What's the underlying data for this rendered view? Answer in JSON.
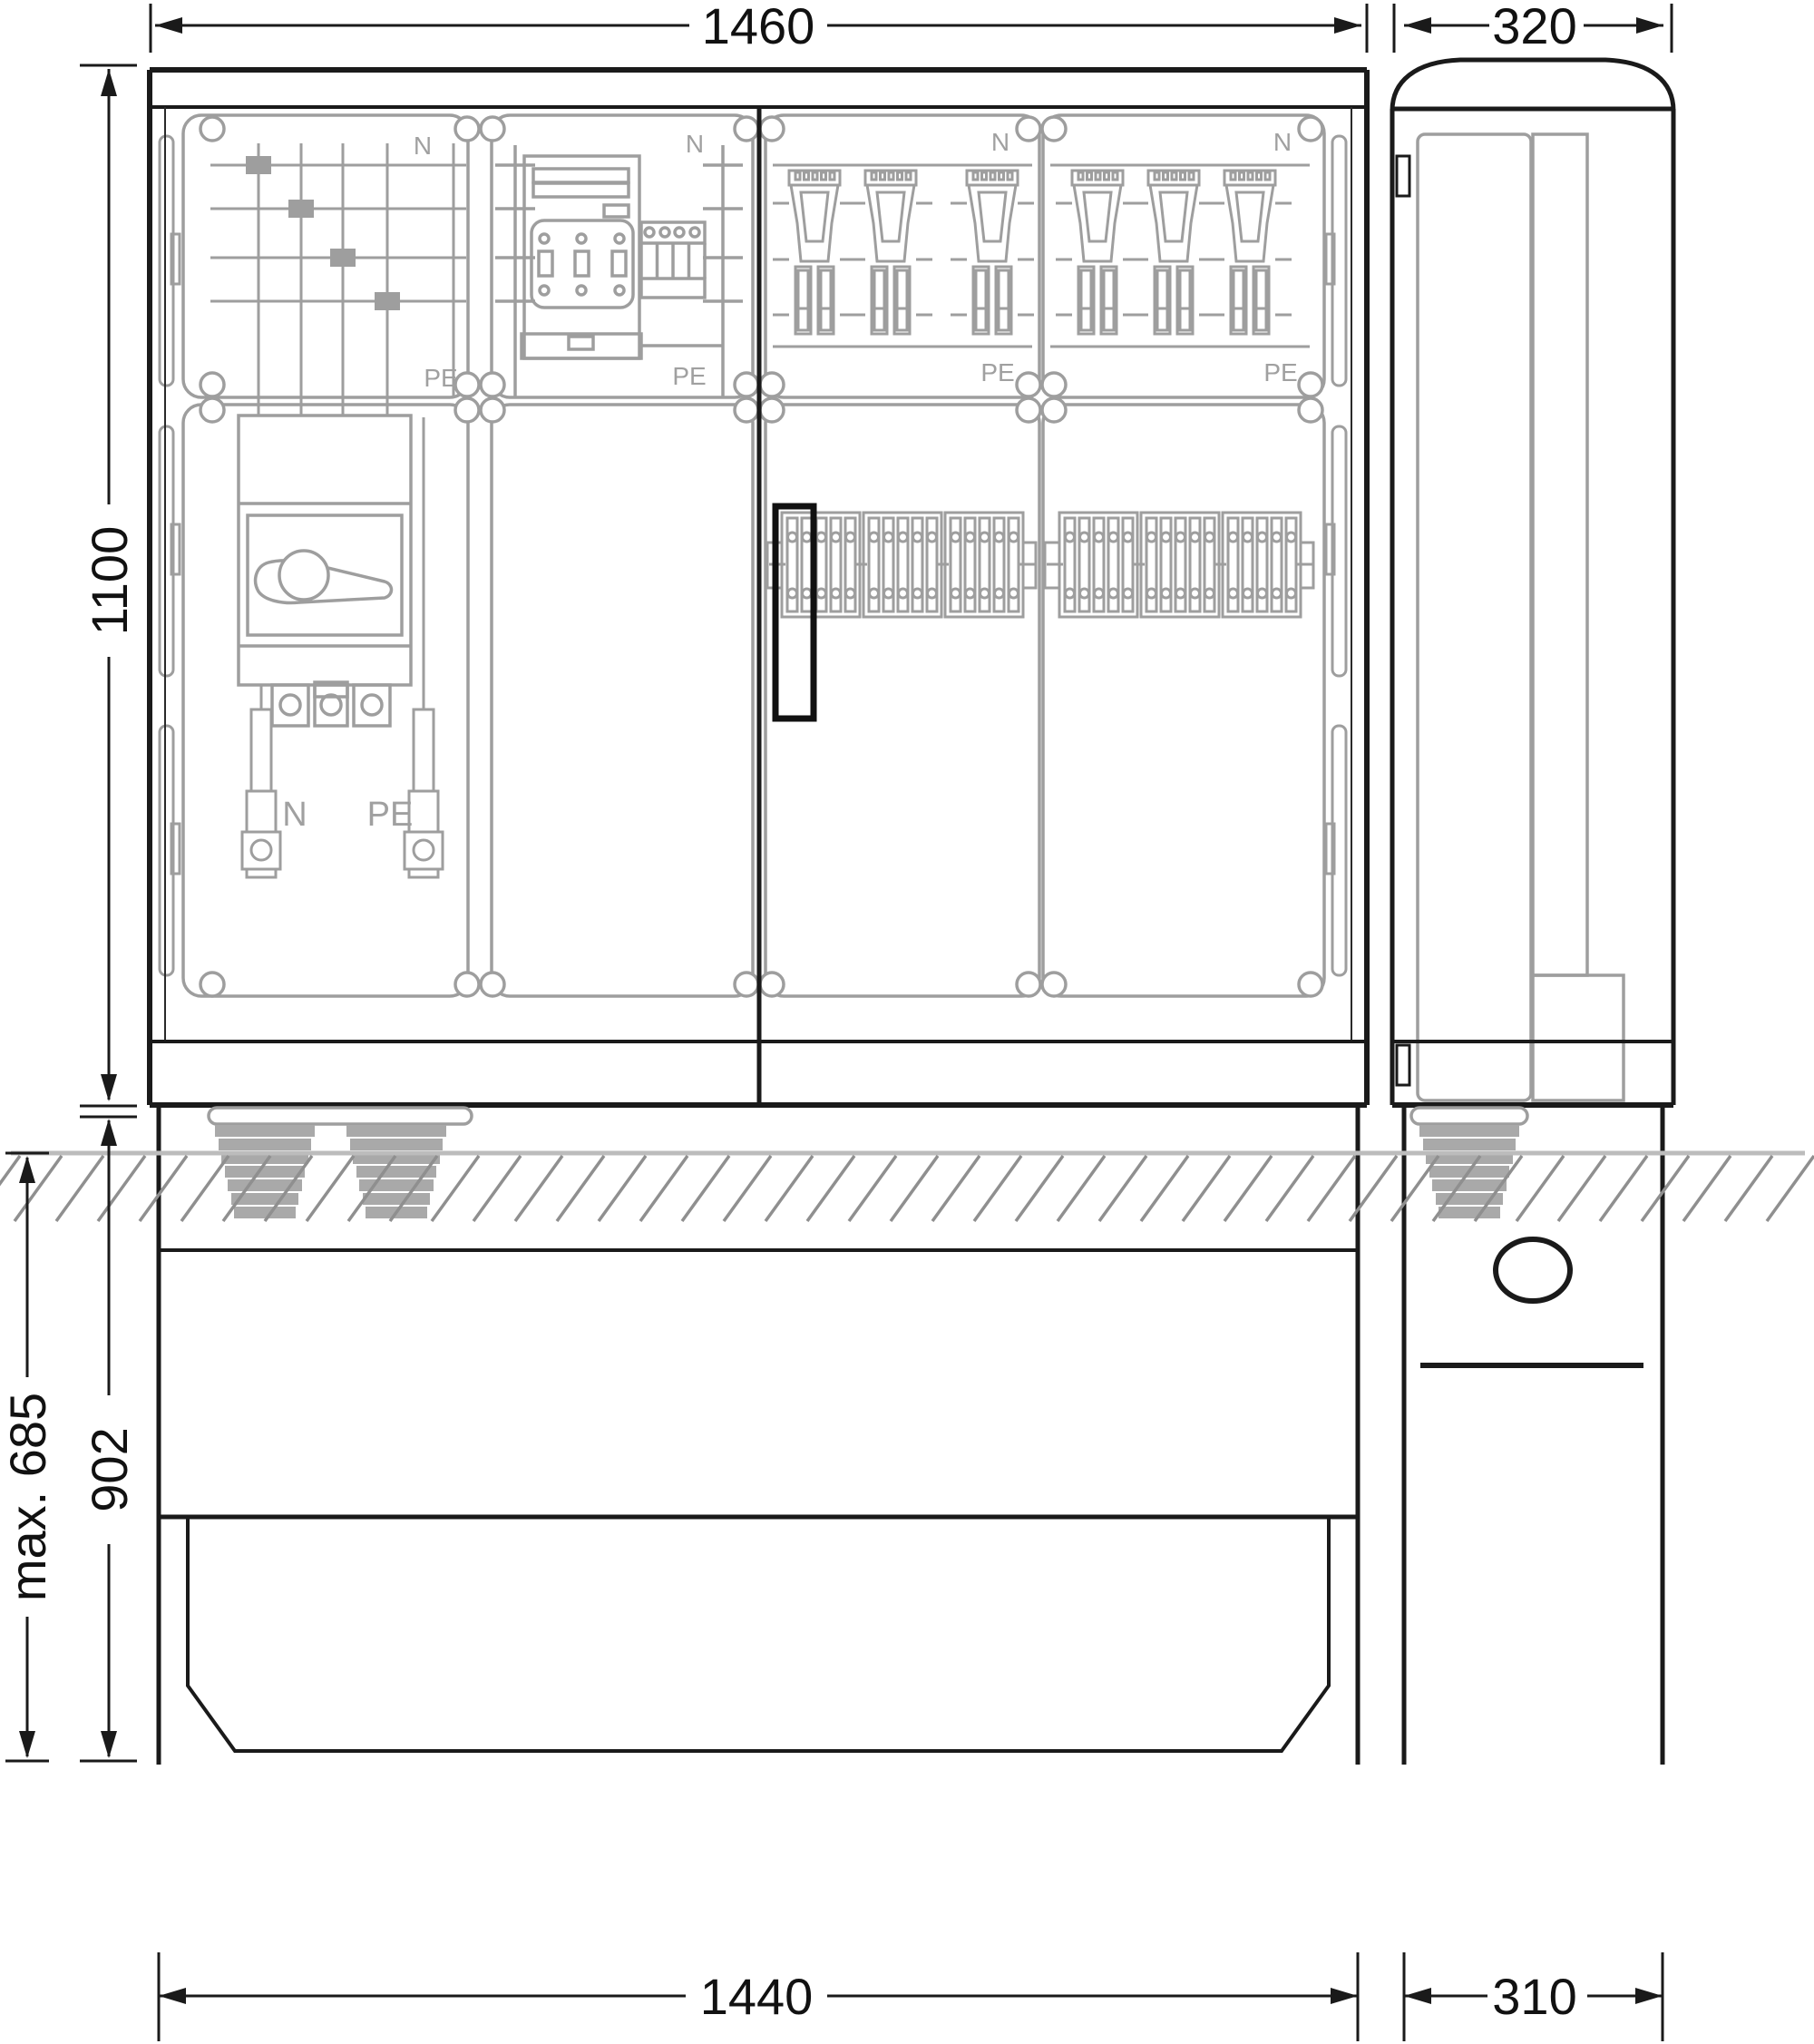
{
  "drawing": {
    "kind": "technical dimensional drawing",
    "subject": "cable distribution cabinet with in-ground pedestal, front and side views",
    "dims": {
      "front_width": "1460",
      "side_width": "320",
      "cabinet_height": "1100",
      "pedestal_height": "902",
      "max_burial_depth": "max. 685",
      "pedestal_front_width": "1440",
      "pedestal_side_width": "310"
    },
    "front_view": {
      "modules": [
        {
          "name": "busbar-and-main-switch-module",
          "n_label": "N",
          "pe_label": "PE"
        },
        {
          "name": "meter-module",
          "n_label": "N",
          "pe_label": "PE"
        },
        {
          "name": "fuse-switch-module-1",
          "n_label": "N",
          "pe_label": "PE"
        },
        {
          "name": "fuse-switch-module-2",
          "n_label": "N",
          "pe_label": "PE"
        }
      ],
      "neutral_bar_label": "N",
      "pe_bar_label": "PE",
      "fuse_count_per_module": 3,
      "terminal_groups_per_module": 3,
      "cable_glands": 2
    },
    "side_view": {
      "cable_glands": 1,
      "cable_entry": "circular conduit opening"
    },
    "colors": {
      "line": "#1a1a1a",
      "component": "#9e9e9e",
      "ground_line": "#bcbcbc",
      "hatch": "#8f8f8f",
      "gland": "#a9a9a9",
      "highlight": "#111111"
    }
  }
}
